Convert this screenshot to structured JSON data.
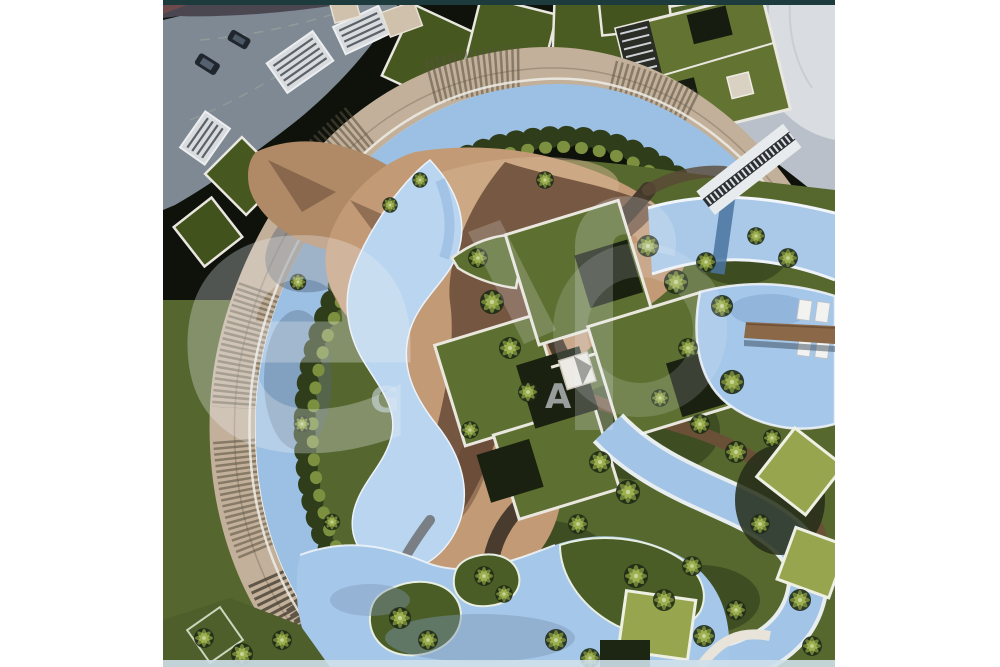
{
  "image": {
    "kind": "aerial-masterplan-rendering",
    "watermark": {
      "big_letter": "e",
      "caption_letter_1": "G",
      "caption_letter_2": "A"
    },
    "palette": {
      "page_bg": "#ffffff",
      "top_strip": "#1d3a3d",
      "parking_gray": "#7e8994",
      "road_gray": "#4a4750",
      "building_beige": "#c2b09a",
      "green_roof": "#4a5c22",
      "lawn": "#57682f",
      "water": "#9cc0e4",
      "water_light": "#a5c7e9",
      "sand": "#c39a76",
      "sand_shadow": "#5f4331",
      "path_brown": "#6b5038",
      "villa_roof": "#97a64e",
      "bottom_strip": "#cfe0ea"
    }
  }
}
